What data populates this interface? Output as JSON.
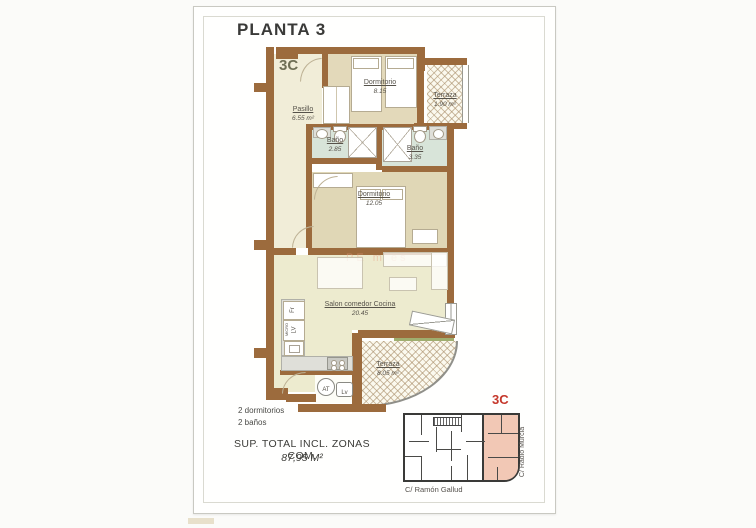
{
  "page": {
    "title": "PLANTA 3",
    "unit_label": "3C"
  },
  "rooms": [
    {
      "name": "Dormitorio",
      "area": "8.15"
    },
    {
      "name": "Terraza",
      "area": "1.90 m²"
    },
    {
      "name": "Pasillo",
      "area": "6.55 m²"
    },
    {
      "name": "Baño",
      "area": "2.85"
    },
    {
      "name": "Baño",
      "area": "3.35"
    },
    {
      "name": "Dormitorio",
      "area": "12.05"
    },
    {
      "name": "Salon comedor Cocina",
      "area": "20.45"
    },
    {
      "name": "Terraza",
      "area": "8.05 m²"
    }
  ],
  "kitchen_labels": {
    "fridge": "Fr",
    "dishwasher": "LV",
    "microwave": "MICRO",
    "water_heater": "AT",
    "laundry": "Lv"
  },
  "watermark": "PE  m es",
  "summary": {
    "bedrooms": "2 dormitorios",
    "bathrooms": "2 baños",
    "total_line1": "SUP. TOTAL INCL. ZONAS COM.",
    "total_line2": "87,95 M²"
  },
  "site_plan": {
    "unit_label": "3C",
    "street_bottom": "C/ Ramón Gallud",
    "street_right": "C/ Radio Murcia"
  },
  "colors": {
    "wall_brown": "#9c6b3d",
    "accent_red": "#c5372b",
    "highlight_pink": "#f2c8b5",
    "bath_green": "#d8e4d9",
    "room_tan": "#e3d9ba",
    "floor_cream": "#f1edd8",
    "salon_green": "#edebcf",
    "unit_label_olive": "#6f6f55"
  }
}
